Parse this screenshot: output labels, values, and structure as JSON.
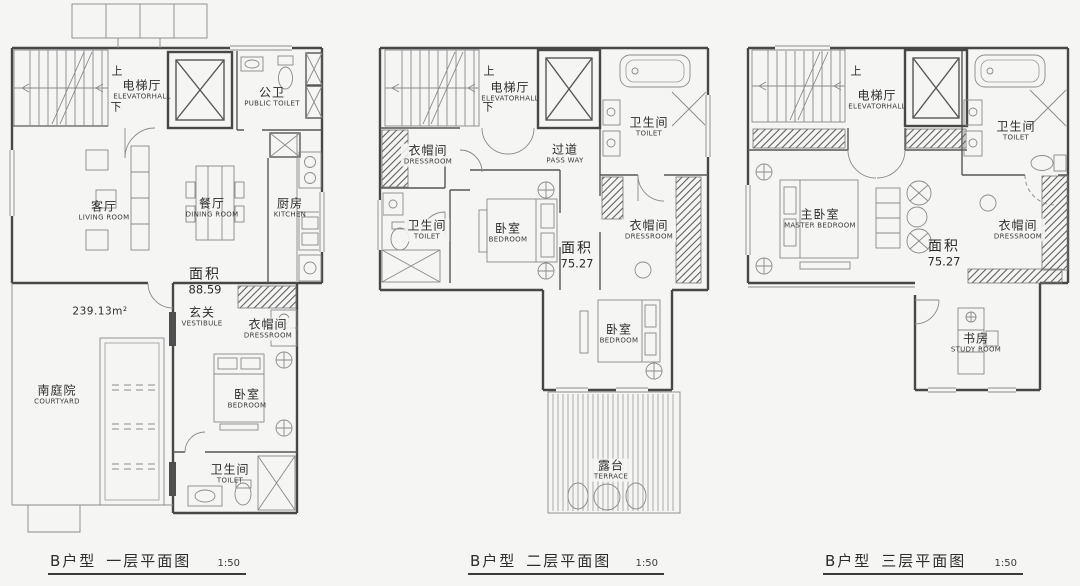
{
  "colors": {
    "background": "#f5f5f3",
    "wall_line": "#474747",
    "text": "#2c2c2c"
  },
  "plans": [
    {
      "id": "floor-1",
      "caption": {
        "unit": "B户型",
        "name": "一层平面图",
        "scale": "1:50"
      },
      "stair": {
        "up": "上",
        "down": "下"
      },
      "area": {
        "label": "面积",
        "value": "88.59"
      },
      "site_area": "239.13m²",
      "rooms": [
        {
          "cn": "电梯厅",
          "en": "ELEVATORHALL"
        },
        {
          "cn": "公卫",
          "en": "PUBLIC TOILET"
        },
        {
          "cn": "客厅",
          "en": "LIVING ROOM"
        },
        {
          "cn": "餐厅",
          "en": "DINING ROOM"
        },
        {
          "cn": "厨房",
          "en": "KITCHEN"
        },
        {
          "cn": "玄关",
          "en": "VESTIBULE"
        },
        {
          "cn": "衣帽间",
          "en": "DRESSROOM"
        },
        {
          "cn": "南庭院",
          "en": "COURTYARD"
        },
        {
          "cn": "卧室",
          "en": "BEDROOM"
        },
        {
          "cn": "卫生间",
          "en": "TOILET"
        }
      ]
    },
    {
      "id": "floor-2",
      "caption": {
        "unit": "B户型",
        "name": "二层平面图",
        "scale": "1:50"
      },
      "stair": {
        "up": "上",
        "down": "下"
      },
      "area": {
        "label": "面积",
        "value": "75.27"
      },
      "rooms": [
        {
          "cn": "电梯厅",
          "en": "ELEVATORHALL"
        },
        {
          "cn": "衣帽间",
          "en": "DRESSROOM"
        },
        {
          "cn": "过道",
          "en": "PASS WAY"
        },
        {
          "cn": "卫生间",
          "en": "TOILET"
        },
        {
          "cn": "卫生间",
          "en": "TOILET"
        },
        {
          "cn": "卧室",
          "en": "BEDROOM"
        },
        {
          "cn": "衣帽间",
          "en": "DRESSROOM"
        },
        {
          "cn": "卧室",
          "en": "BEDROOM"
        },
        {
          "cn": "露台",
          "en": "TERRACE"
        }
      ]
    },
    {
      "id": "floor-3",
      "caption": {
        "unit": "B户型",
        "name": "三层平面图",
        "scale": "1:50"
      },
      "stair": {
        "up": "上"
      },
      "area": {
        "label": "面积",
        "value": "75.27"
      },
      "rooms": [
        {
          "cn": "电梯厅",
          "en": "ELEVATORHALL"
        },
        {
          "cn": "卫生间",
          "en": "TOILET"
        },
        {
          "cn": "主卧室",
          "en": "MASTER BEDROOM"
        },
        {
          "cn": "衣帽间",
          "en": "DRESSROOM"
        },
        {
          "cn": "书房",
          "en": "STUDY ROOM"
        }
      ]
    }
  ]
}
